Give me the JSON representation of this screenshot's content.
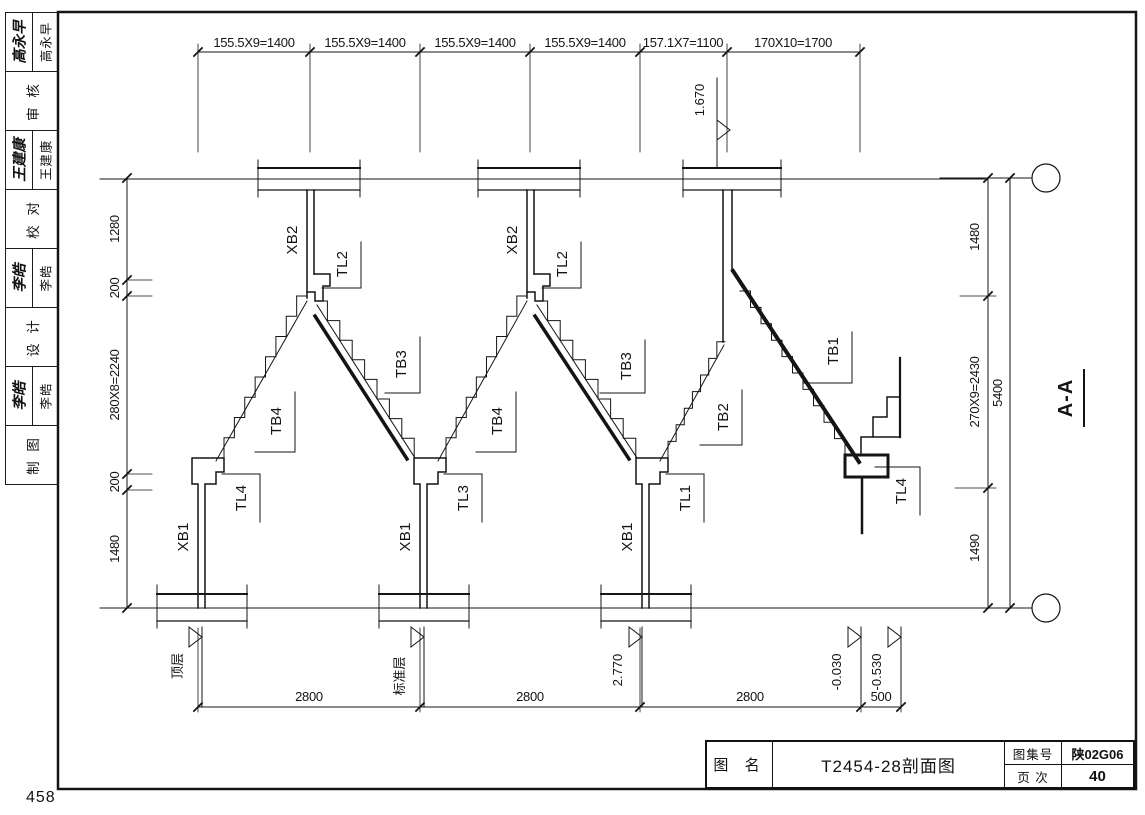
{
  "page": {
    "corner_number": "458"
  },
  "sidebar": {
    "rows": [
      {
        "signature": "高永早",
        "name": "高永早"
      },
      {
        "label": "审 核"
      },
      {
        "signature": "王建康",
        "name": "王建康"
      },
      {
        "label": "校 对"
      },
      {
        "signature": "李皓",
        "name": "李皓"
      },
      {
        "label": "设 计"
      },
      {
        "signature": "李皓",
        "name": "李皓"
      },
      {
        "label": "制 图"
      }
    ]
  },
  "title_block": {
    "name_label": "图 名",
    "drawing_name": "T2454-28剖面图",
    "atlas_label": "图集号",
    "atlas_no": "陕02G06",
    "page_label": "页 次",
    "page_no": "40"
  },
  "drawing": {
    "section_title": "A-A",
    "dims_top": [
      "155.5X9=1400",
      "155.5X9=1400",
      "155.5X9=1400",
      "155.5X9=1400",
      "157.1X7=1100",
      "170X10=1700"
    ],
    "dims_left": [
      "1280",
      "200",
      "280X8=2240",
      "200",
      "1480"
    ],
    "dims_right": [
      "1480",
      "270X9=2430",
      "1490"
    ],
    "dim_total_right": "5400",
    "dims_bottom": [
      "2800",
      "2800",
      "2800",
      "500"
    ],
    "elevations": {
      "upper": "1.670",
      "mid": "2.770",
      "minus030": "-0.030",
      "minus530": "-0.530"
    },
    "floor_labels": {
      "top": "顶层",
      "standard": "标准层"
    },
    "labels": {
      "xb1": "XB1",
      "xb2": "XB2",
      "tl1": "TL1",
      "tl2": "TL2",
      "tl3": "TL3",
      "tl4": "TL4",
      "tb1": "TB1",
      "tb2": "TB2",
      "tb3": "TB3",
      "tb4": "TB4"
    }
  }
}
